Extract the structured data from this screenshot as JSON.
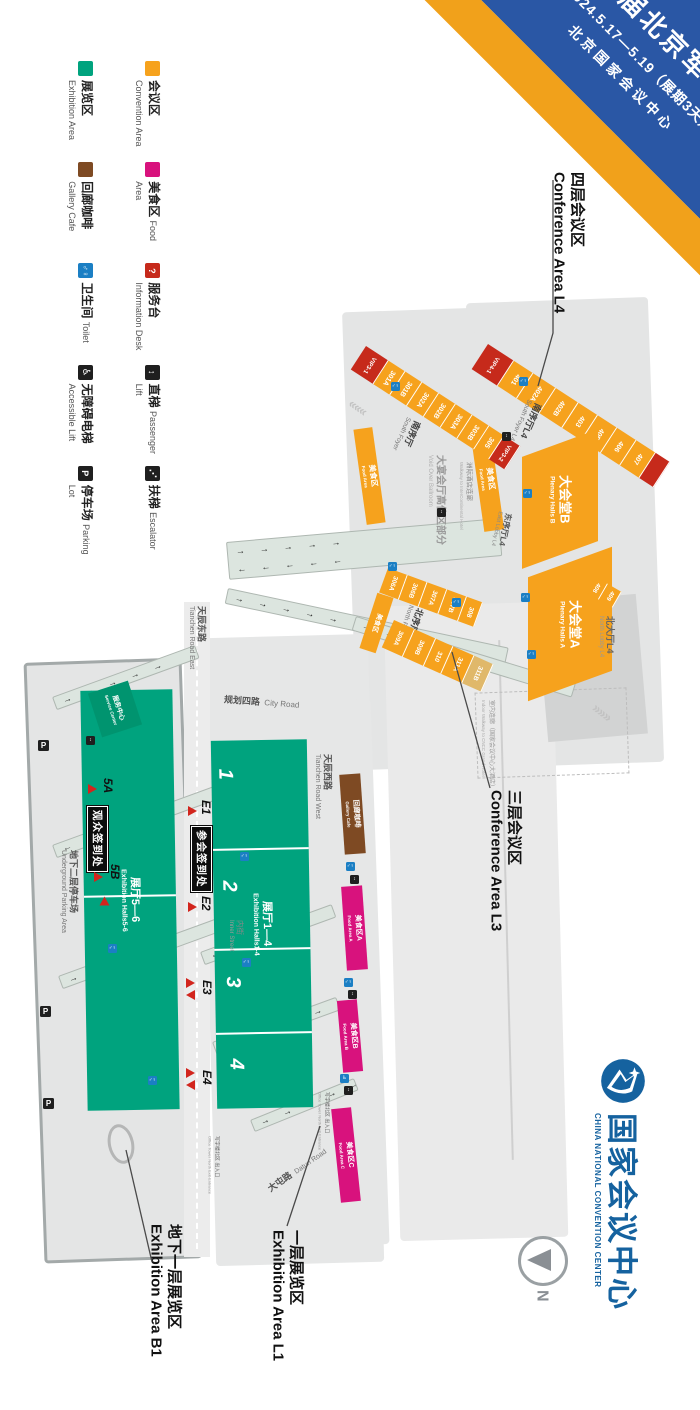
{
  "banner": {
    "title": "第九届北京军博会",
    "dates": "2024.5.17—5.19（展期3天）",
    "venue": "北京国家会议中心"
  },
  "glyphs": {
    "question": "?",
    "p": "P",
    "n": "N",
    "toilet": "♂♀",
    "lift": "↕",
    "wheelchair": "♿",
    "escalator": "⋰"
  },
  "legend": {
    "items": [
      {
        "cn": "会议区",
        "en": "Convention Area"
      },
      {
        "cn": "美食区",
        "en": "Food Area"
      },
      {
        "cn": "服务台",
        "en": "Information Desk"
      },
      {
        "cn": "直梯",
        "en": "Passenger Lift"
      },
      {
        "cn": "扶梯",
        "en": "Escalator"
      },
      {
        "cn": "展览区",
        "en": "Exhibition Area"
      },
      {
        "cn": "回廊咖啡",
        "en": "Gallery Cafe"
      },
      {
        "cn": "卫生间",
        "en": "Toilet"
      },
      {
        "cn": "无障碍电梯",
        "en": "Accessible Lift"
      },
      {
        "cn": "停车场",
        "en": "Parking Lot"
      }
    ]
  },
  "l4": {
    "area_label": {
      "cn": "四层会议区",
      "en": "Conference Area L4"
    },
    "rooms": [
      "VIP4-1",
      "401",
      "402A",
      "402B",
      "403",
      "405",
      "406",
      "407"
    ],
    "rooms2": [
      "408",
      "409"
    ],
    "south_foyer": {
      "cn": "南序厅L4",
      "en": "South Foyer L4"
    },
    "east_lobby": {
      "cn": "东序厅L4",
      "en": "East Lobby L4"
    },
    "north_lobby": {
      "cn": "北大厅L4",
      "en": "North Lobby L4"
    },
    "hall_b": {
      "cn": "大会堂B",
      "en": "Plenary Halls B"
    },
    "hall_a": {
      "cn": "大会堂A",
      "en": "Plenary Halls A"
    },
    "food": {
      "cn": "美食区",
      "en": "Food Area"
    },
    "walkway_note": {
      "cn": "室内连廊（国家会议中心大酒店）",
      "en": "Indoor Walkway to CNCC Grand Hotel"
    }
  },
  "l3": {
    "area_label": {
      "cn": "三层会议区",
      "en": "Conference Area L3"
    },
    "rooms1": [
      "VIP3-1",
      "301A",
      "301B",
      "302A",
      "302B",
      "303A",
      "303B",
      "305",
      "VIP3-2"
    ],
    "rooms2": [
      "306A",
      "306B",
      "307A",
      "307B",
      "308"
    ],
    "rooms3": [
      "309A",
      "309B",
      "310",
      "311A",
      "311B"
    ],
    "south_foyer": {
      "cn": "南序厅",
      "en": "South Foyer"
    },
    "north_foyer": {
      "cn": "北序厅",
      "en": "North Foyer"
    },
    "ballroom_void": {
      "cn": "大宴会厅高位区部分",
      "en": "Void Over Ballroom"
    },
    "food": {
      "cn": "美食区",
      "en": "Food Area"
    },
    "intercontinental": {
      "cn": "洲际酒店连廊",
      "en": "Walkway to InterContinental Hotel"
    }
  },
  "l1": {
    "area_label": {
      "cn": "一层展览区",
      "en": "Exhibition Area L1"
    },
    "hall": {
      "cn": "展厅1—4",
      "en": "Exhibition Halls1-4"
    },
    "hall_numbers": [
      "1",
      "2",
      "3",
      "4"
    ],
    "entrances": [
      "E1",
      "E2",
      "E3",
      "E4"
    ],
    "reg_badge": "参会签到处",
    "roads": {
      "tianchen_east": {
        "cn": "天辰东路",
        "en": "Tianchen Road East"
      },
      "tianchen_west": {
        "cn": "天辰西路",
        "en": "Tianchen Road West"
      },
      "city": {
        "cn": "规划四路",
        "en": "City Road"
      },
      "datun": {
        "cn": "大屯路",
        "en": "Datun Road"
      },
      "inner": {
        "cn": "内街",
        "en": "Inner Street"
      }
    },
    "gallery_cafe": {
      "cn": "回廊咖啡",
      "en": "Gallery Cafe"
    },
    "food_areas": [
      {
        "cn": "美食区A",
        "en": "Food Area A"
      },
      {
        "cn": "美食区B",
        "en": "Food Area B"
      },
      {
        "cn": "美食区C",
        "en": "Food Area C"
      }
    ],
    "office_tower": {
      "cn": "写字楼北区 出入口",
      "en": "Office Tower North Exit·Entrance"
    }
  },
  "b1": {
    "area_label": {
      "cn": "地下一层展览区",
      "en": "Exhibition Area B1"
    },
    "hall": {
      "cn": "展厅5—6",
      "en": "Exhibition Halls5-6"
    },
    "entrances": [
      "5A",
      "5B"
    ],
    "reg_badge": "观众签到处",
    "service_center": {
      "cn": "服务中心",
      "en": "Service Center"
    },
    "parking": {
      "cn": "地下二层停车场",
      "en": "Underground Parking Area"
    }
  },
  "logo": {
    "cn": "国家会议中心",
    "en": "CHINA NATIONAL CONVENTION CENTER"
  },
  "colors": {
    "convention": "#F6A21D",
    "vip": "#C62A1B",
    "exhibition": "#00A37E",
    "food": "#D8127D",
    "cafe": "#7E4A23",
    "toilet": "#1B7FC4",
    "banner_blue": "#2A57A5",
    "banner_orange": "#F1A11B",
    "logo_blue": "#15629F"
  }
}
